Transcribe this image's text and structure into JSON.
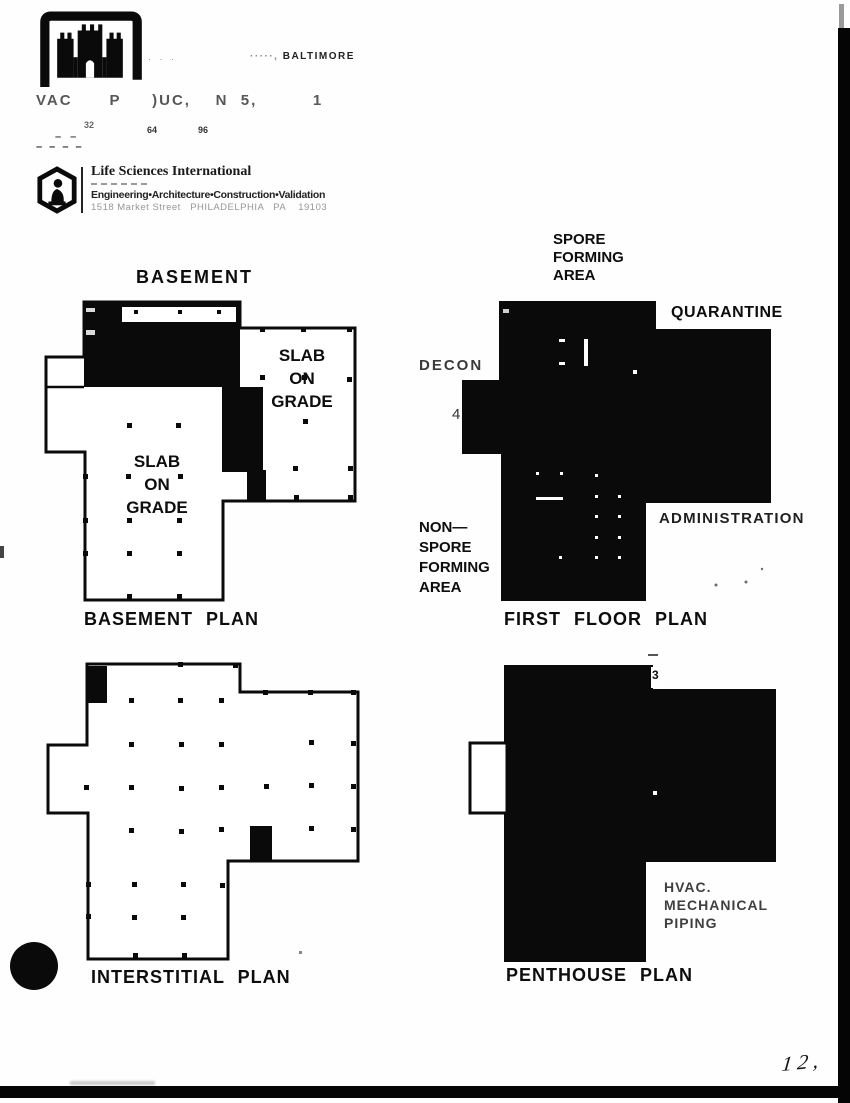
{
  "document": {
    "logo_marks": "· · ·",
    "district_line": {
      "faded_prefix": "·····,",
      "name": "BALTIMORE"
    },
    "project_line": "VAC      P     )UC,    N  5,         1",
    "scale_bar": {
      "ticks": [
        "32",
        "64",
        "96"
      ],
      "dashes_top": "– –",
      "dashes_bottom": "– – – –"
    },
    "firm": {
      "name": "Life Sciences International",
      "tagline": "Engineering•Architecture•Construction•Validation",
      "address": "1518 Market Street   PHILADELPHIA   PA    19103"
    },
    "page_number": "12,"
  },
  "plans": {
    "basement": {
      "title": "BASEMENT",
      "slab_on_grade_right": "SLAB\nON\nGRADE",
      "slab_on_grade_lower": "SLAB\nON\nGRADE",
      "caption": "BASEMENT PLAN"
    },
    "first_floor": {
      "spore_area": "SPORE\nFORMING\nAREA",
      "quarantine": "QUARANTINE",
      "decon": "DECON",
      "non_spore_area": "NON—\nSPORE\nFORMING\nAREA",
      "administration": "ADMINISTRATION",
      "caption": "FIRST FLOOR PLAN",
      "section_marker": "4"
    },
    "interstitial": {
      "caption": "INTERSTITIAL PLAN"
    },
    "penthouse": {
      "hvac_label": "HVAC.\nMECHANICAL\nPIPING",
      "caption": "PENTHOUSE PLAN",
      "section_marker": "3"
    }
  }
}
